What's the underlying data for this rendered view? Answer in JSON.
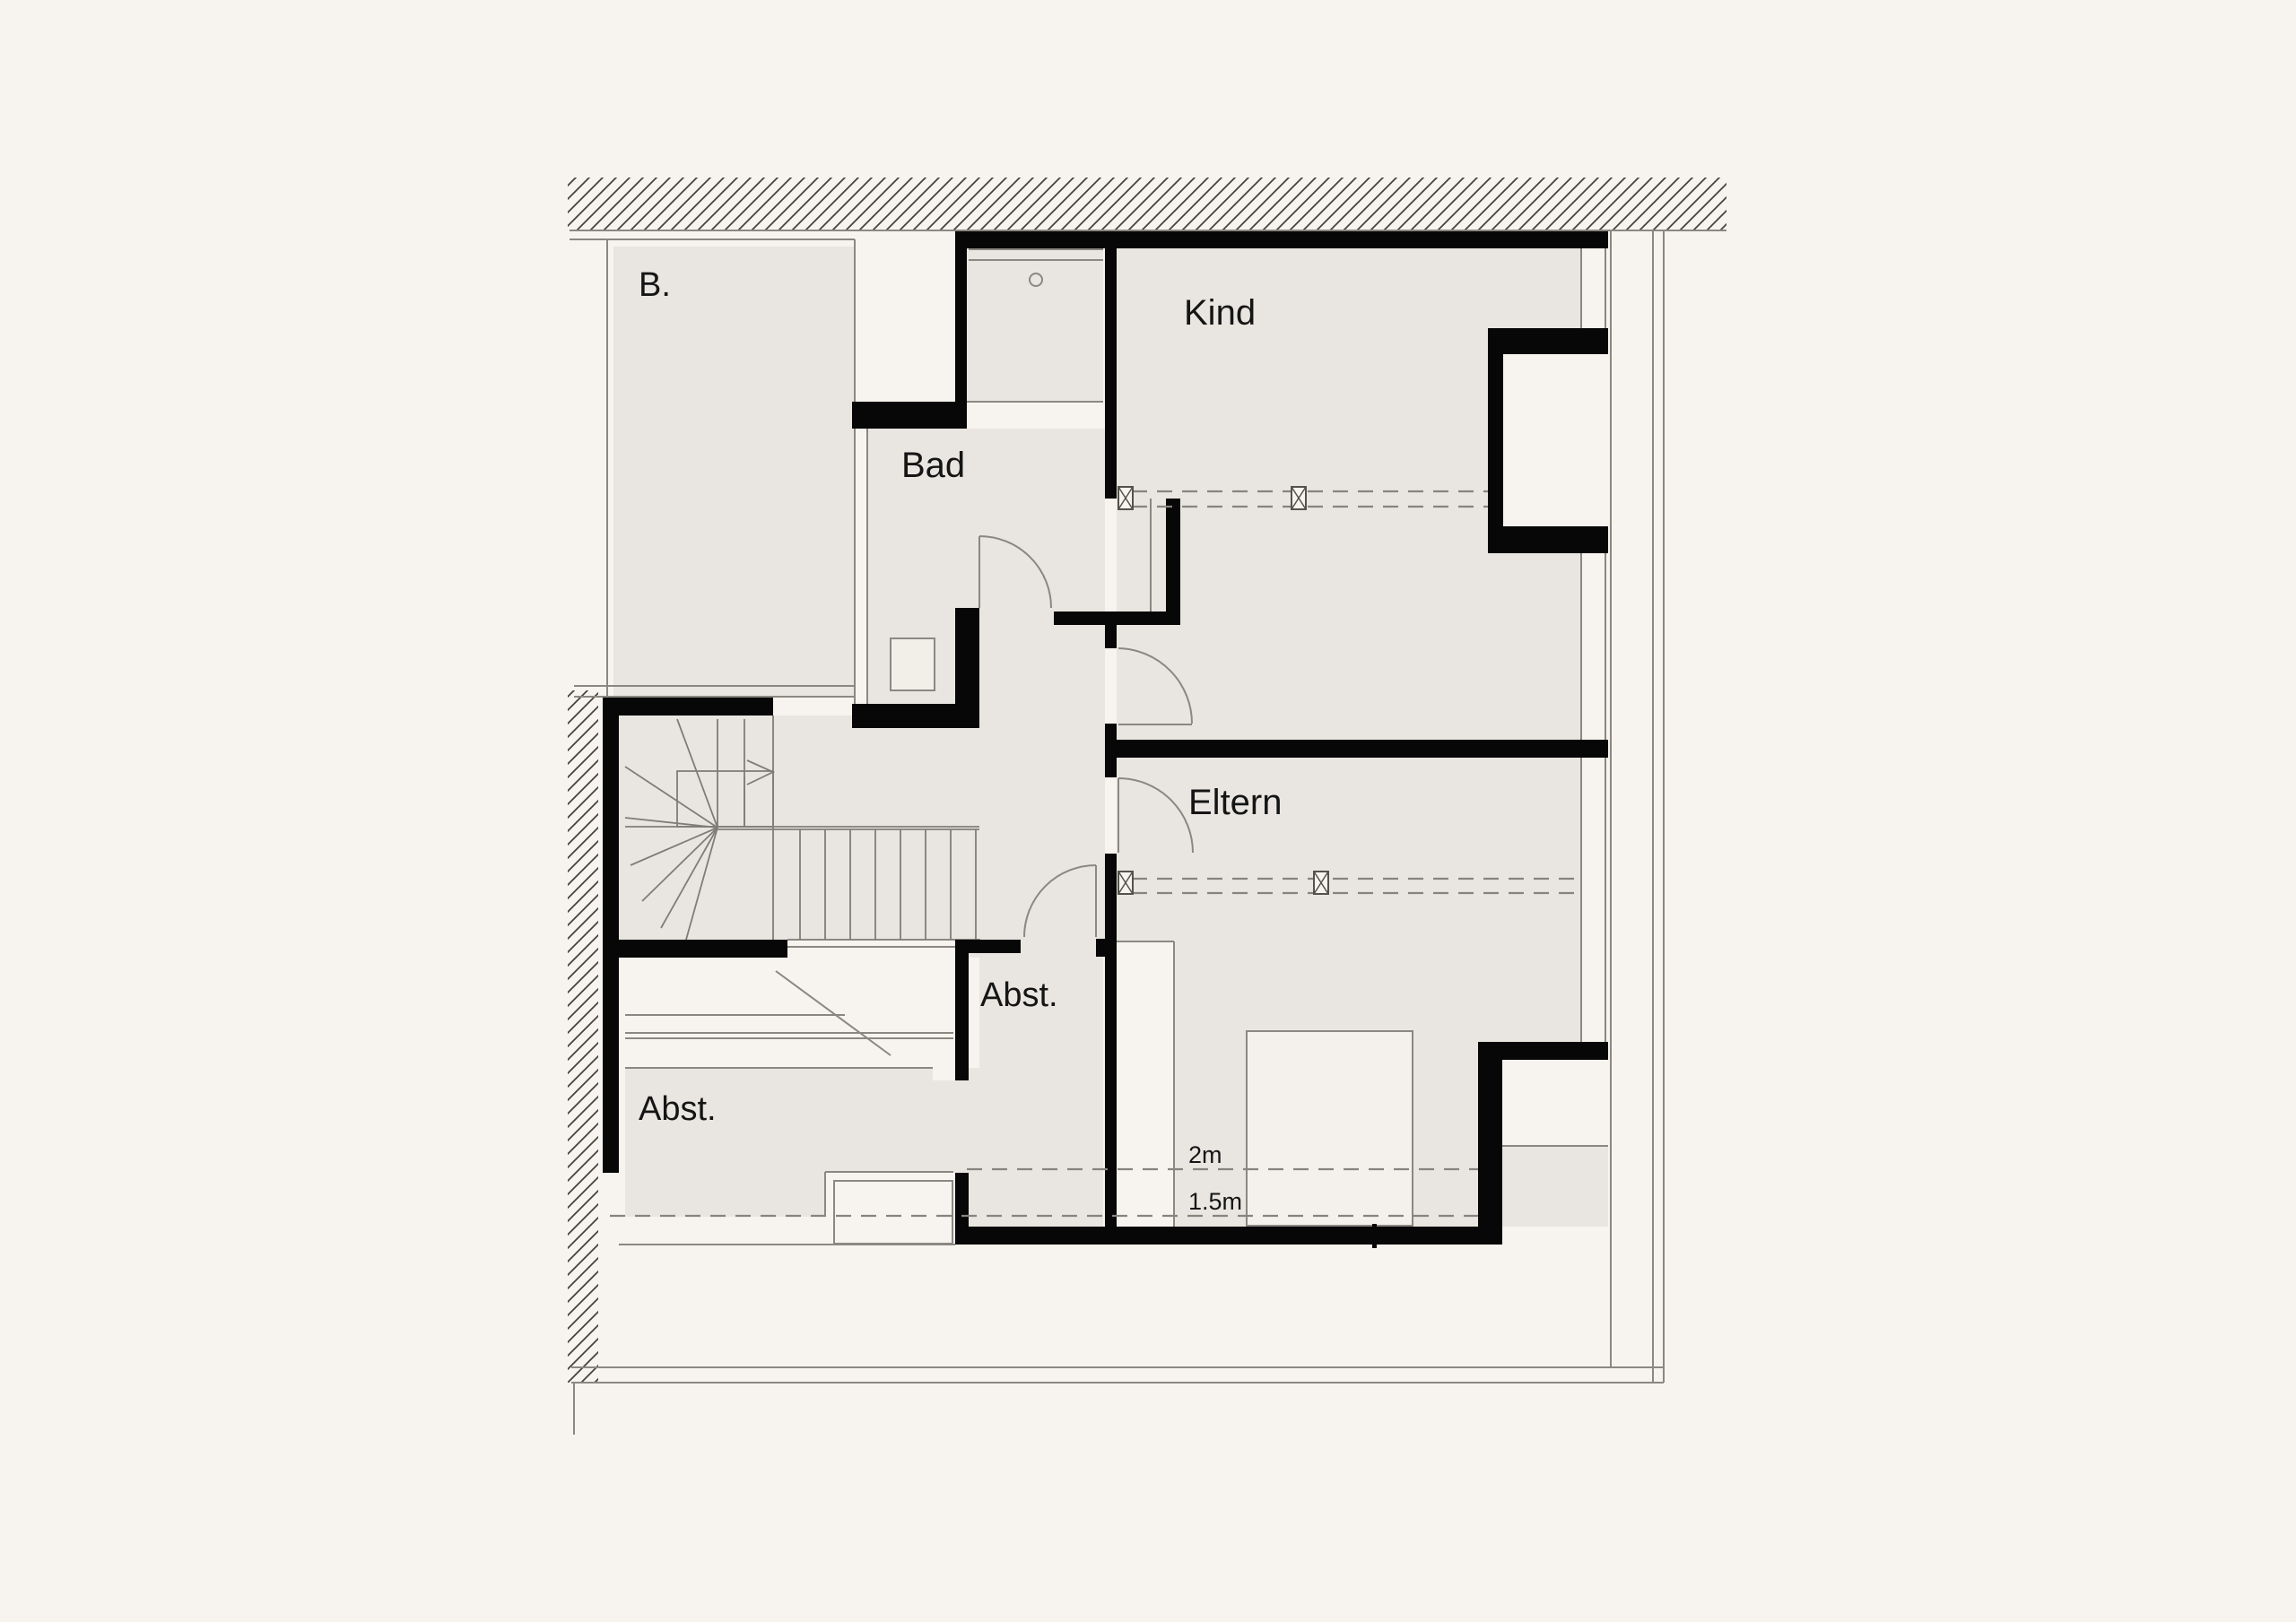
{
  "plan": {
    "rooms": {
      "balcony": {
        "label": "B."
      },
      "bath": {
        "label": "Bad"
      },
      "child": {
        "label": "Kind"
      },
      "parents": {
        "label": "Eltern"
      },
      "storage_center": {
        "label": "Abst."
      },
      "storage_left": {
        "label": "Abst."
      }
    },
    "height_lines": {
      "two_m": {
        "label": "2m"
      },
      "one_point_five_m": {
        "label": "1.5m"
      }
    },
    "colors": {
      "background": "#f7f3ee",
      "room_fill": "#e9e6e1",
      "wall": "#070707",
      "thin_line": "#8b8781"
    }
  }
}
